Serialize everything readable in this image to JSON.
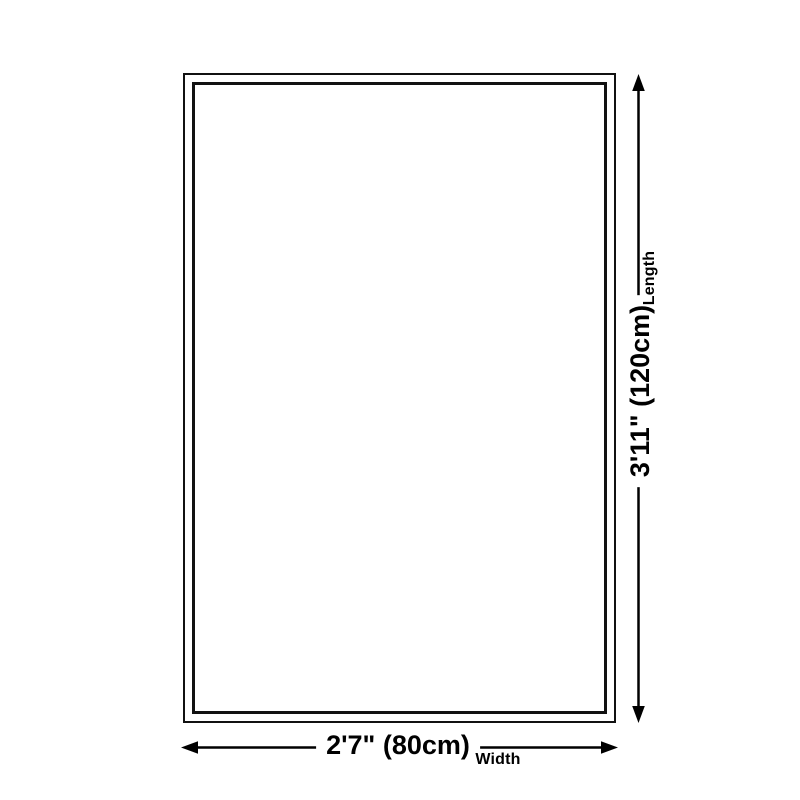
{
  "diagram": {
    "title": "rug-size-dimension-diagram",
    "background_color": "#ffffff",
    "line_color": "#000000",
    "outline_border_color": "#111111",
    "width": {
      "value": "2'7\" (80cm)",
      "caption": "Width"
    },
    "length": {
      "value": "3'11\" (120cm)",
      "caption": "Length"
    }
  }
}
